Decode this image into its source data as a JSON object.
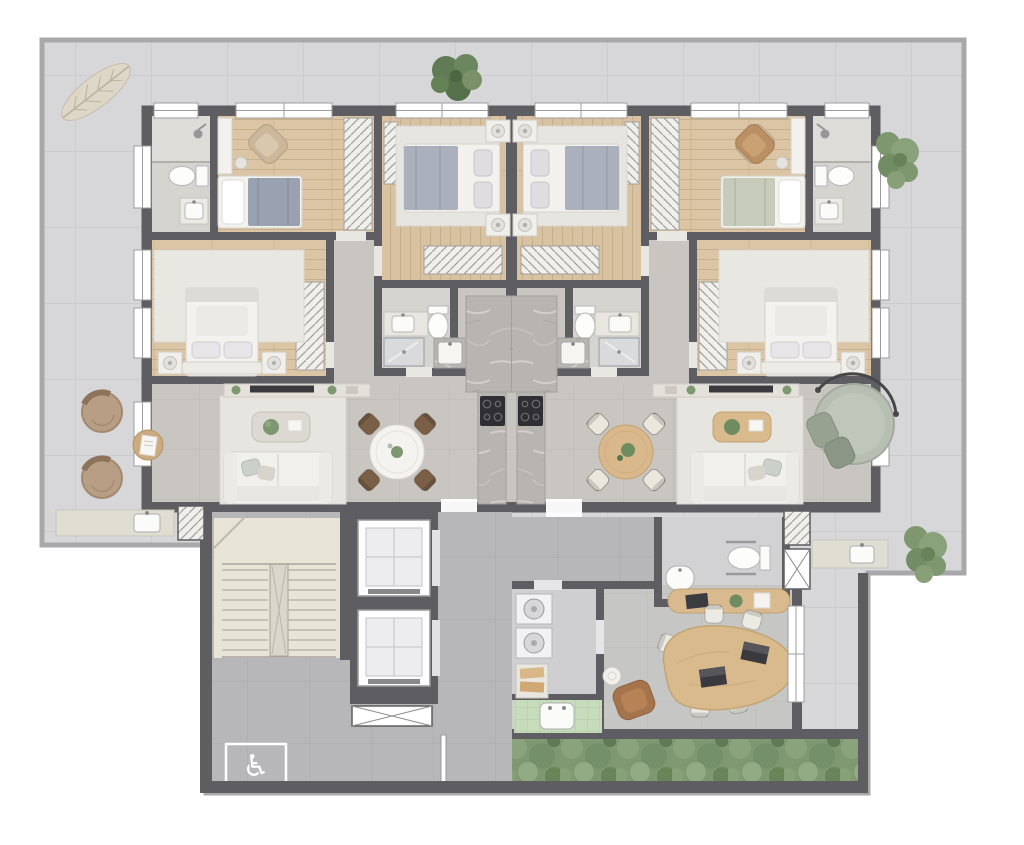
{
  "meta": {
    "type": "architectural floor plan",
    "view": "top-down colored render of a residential floor",
    "description": "Two mirrored apartments at top, central stair and elevator core at bottom left, office wing at bottom right, wrap-around tiled terrace"
  },
  "icons": {
    "wheelchair": "♿"
  },
  "palette": {
    "background": "#ffffff",
    "terrace_floor": "#d7d7d9",
    "terrace_line": "#a8a8aa",
    "wall": "#5e5e62",
    "wood_floor": "#dbc5a4",
    "unit_floor": "#c9c5c0",
    "bath_floor": "#d6d4d0",
    "lobby_floor": "#b7b7b9",
    "stair_floor": "#e8e5d7",
    "marble_counter": "#b8b4b1",
    "rug": "#e9e7e1",
    "upholstery_white": "#f1f0ec",
    "blanket_blue_gray": "#9aa1b0",
    "blanket_sage": "#c6ccb9",
    "armchair_brown": "#a5744d",
    "wood_furniture": "#d9ba8c",
    "tree_green": "#5f7a54",
    "hedge_green": "#7f9871",
    "wc_tile_green": "#c7dcba",
    "cooktop_black": "#2f2f33"
  },
  "building": {
    "apartment_left": {
      "rooms": [
        {
          "name": "ensuite bathroom",
          "fixtures": [
            "shower",
            "toilet",
            "vanity sink"
          ]
        },
        {
          "name": "small bedroom",
          "furniture": [
            "single bed with blue-gray blanket",
            "desk",
            "stool",
            "armchair",
            "hatched wardrobe"
          ]
        },
        {
          "name": "center bedroom",
          "furniture": [
            "double bed",
            "two nightstands with lamps",
            "rug",
            "wardrobe strip",
            "closet"
          ]
        },
        {
          "name": "master bedroom",
          "furniture": [
            "double bed",
            "two nightstands",
            "rug",
            "hatched wardrobe",
            "tv console"
          ]
        },
        {
          "name": "bathroom",
          "fixtures": [
            "vanity sink",
            "toilet",
            "shower",
            "shower column in marble niche"
          ]
        },
        {
          "name": "kitchen",
          "fixtures": [
            "marble T-counter",
            "black cooktop",
            "kitchen sink"
          ]
        },
        {
          "name": "living dining room",
          "furniture": [
            "white sofa",
            "coffee table with plant",
            "tv console",
            "round white dining table",
            "four dark wood chairs",
            "rug",
            "terrace door"
          ]
        }
      ]
    },
    "apartment_right": {
      "mirrors": "apartment_left",
      "variants": [
        "single bed with sage blanket",
        "brown armchair",
        "round wood dining table",
        "four cream chairs",
        "wood coffee table"
      ]
    },
    "core": {
      "elements": [
        "U staircase with landing",
        "two elevators",
        "ventilation shaft with X",
        "concrete lobby",
        "accessible wheelchair floor marking",
        "open door leaf"
      ]
    },
    "office_wing": {
      "elements": [
        "corridor",
        "accessible wc with grab bars and corner sink",
        "laundry room with two machines and towel shelf",
        "green tiled wc",
        "office with organic wood meeting table",
        "six office chairs",
        "two laptops",
        "wood credenza",
        "brown lounge chair",
        "round side table",
        "full-height window wall",
        "hedge planter strip"
      ]
    },
    "terrace": {
      "elements": [
        "wrap-around tiled terrace",
        "dry leaf decoration",
        "tree",
        "three shrubs",
        "round sage daybed with canopy",
        "two round brown lounge chairs",
        "round wood side table with papers",
        "two outdoor counters with sinks"
      ]
    }
  }
}
